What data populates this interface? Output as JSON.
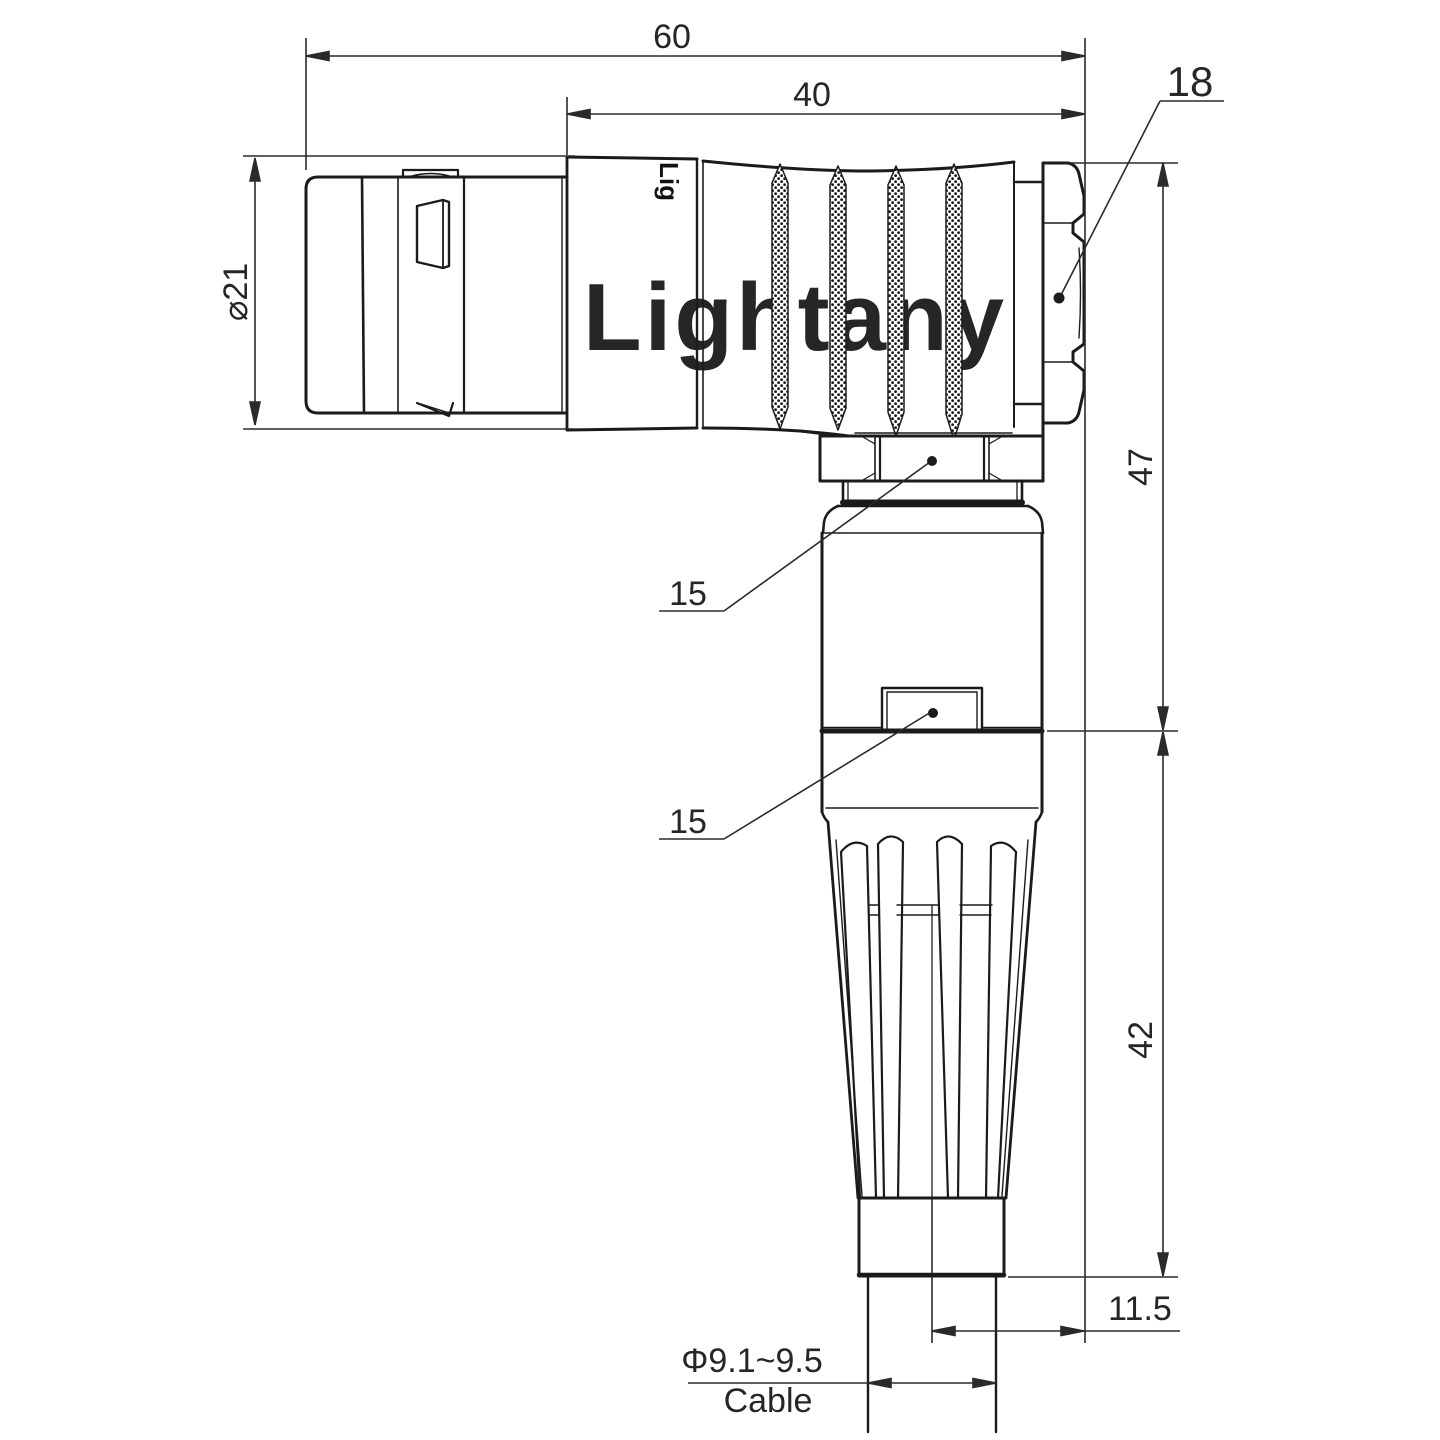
{
  "drawing": {
    "watermark": "Lightany",
    "body_marking": "Lig",
    "dims": {
      "overall_length": "60",
      "front_length": "40",
      "hex_size": "18",
      "barrel_dia": "⌀21",
      "height_upper": "47",
      "height_lower": "42",
      "nut_label_upper": "15",
      "nut_label_lower": "15",
      "offset": "11.5",
      "cable_dia": "Φ9.1~9.5",
      "cable_label": "Cable"
    },
    "colors": {
      "line": "#1b1b1b",
      "dim_line": "#2a2a2a",
      "watermark": "#f6c8c9",
      "background": "#ffffff"
    }
  }
}
